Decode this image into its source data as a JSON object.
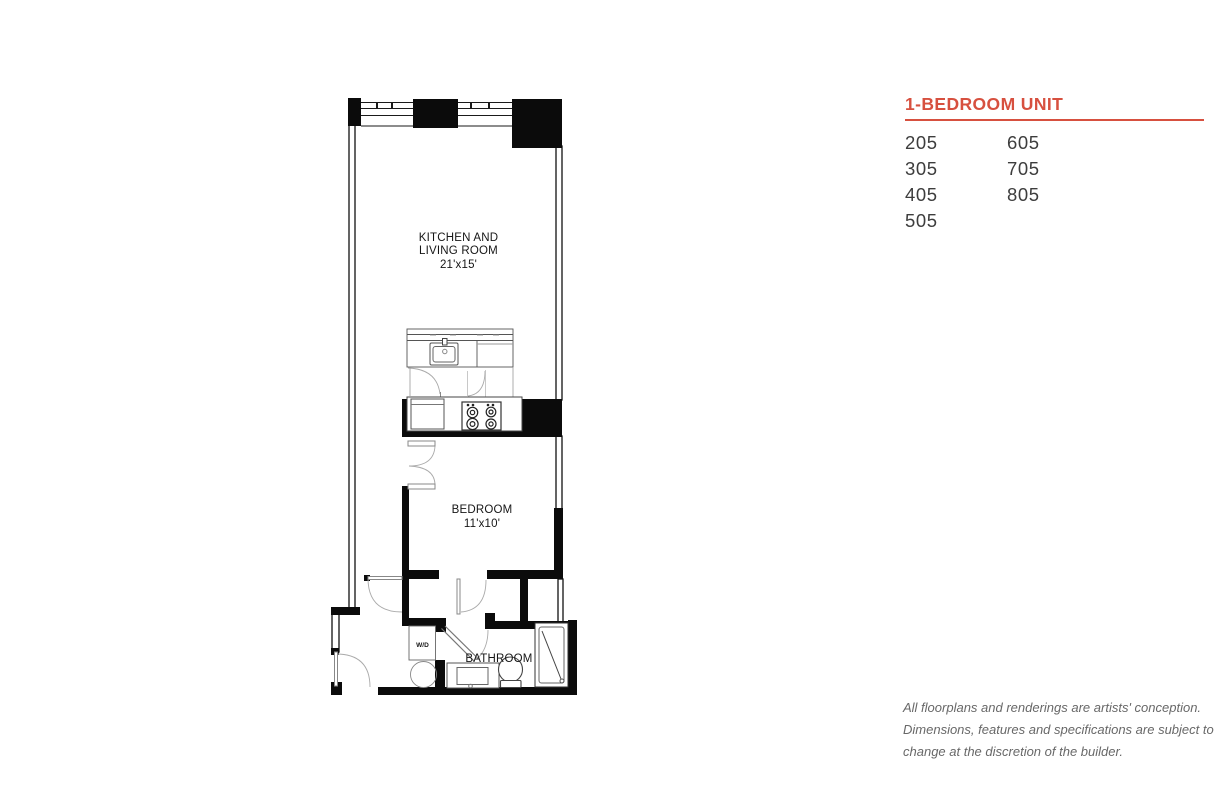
{
  "panel": {
    "title": "1-BEDROOM UNIT",
    "accent_color": "#d7503f",
    "unit_numbers": {
      "column1": [
        "205",
        "305",
        "405",
        "505"
      ],
      "column2": [
        "605",
        "705",
        "805"
      ]
    },
    "disclaimer_lines": [
      "All floorplans and renderings are artists' conception.",
      "Dimensions, features and specifications are subject to",
      "change at the discretion of the builder."
    ]
  },
  "floorplan": {
    "labels": {
      "kitchen_living_line1": "KITCHEN AND",
      "kitchen_living_line2": "LIVING ROOM",
      "kitchen_living_dims": "21'x15'",
      "bedroom": "BEDROOM",
      "bedroom_dims": "11'x10'",
      "bathroom": "BATHROOM",
      "washer_dryer": "W/D"
    },
    "wall_color": "#0b0b0b",
    "fixture_line_color": "#555555",
    "door_arc_color": "#aaaaaa"
  }
}
